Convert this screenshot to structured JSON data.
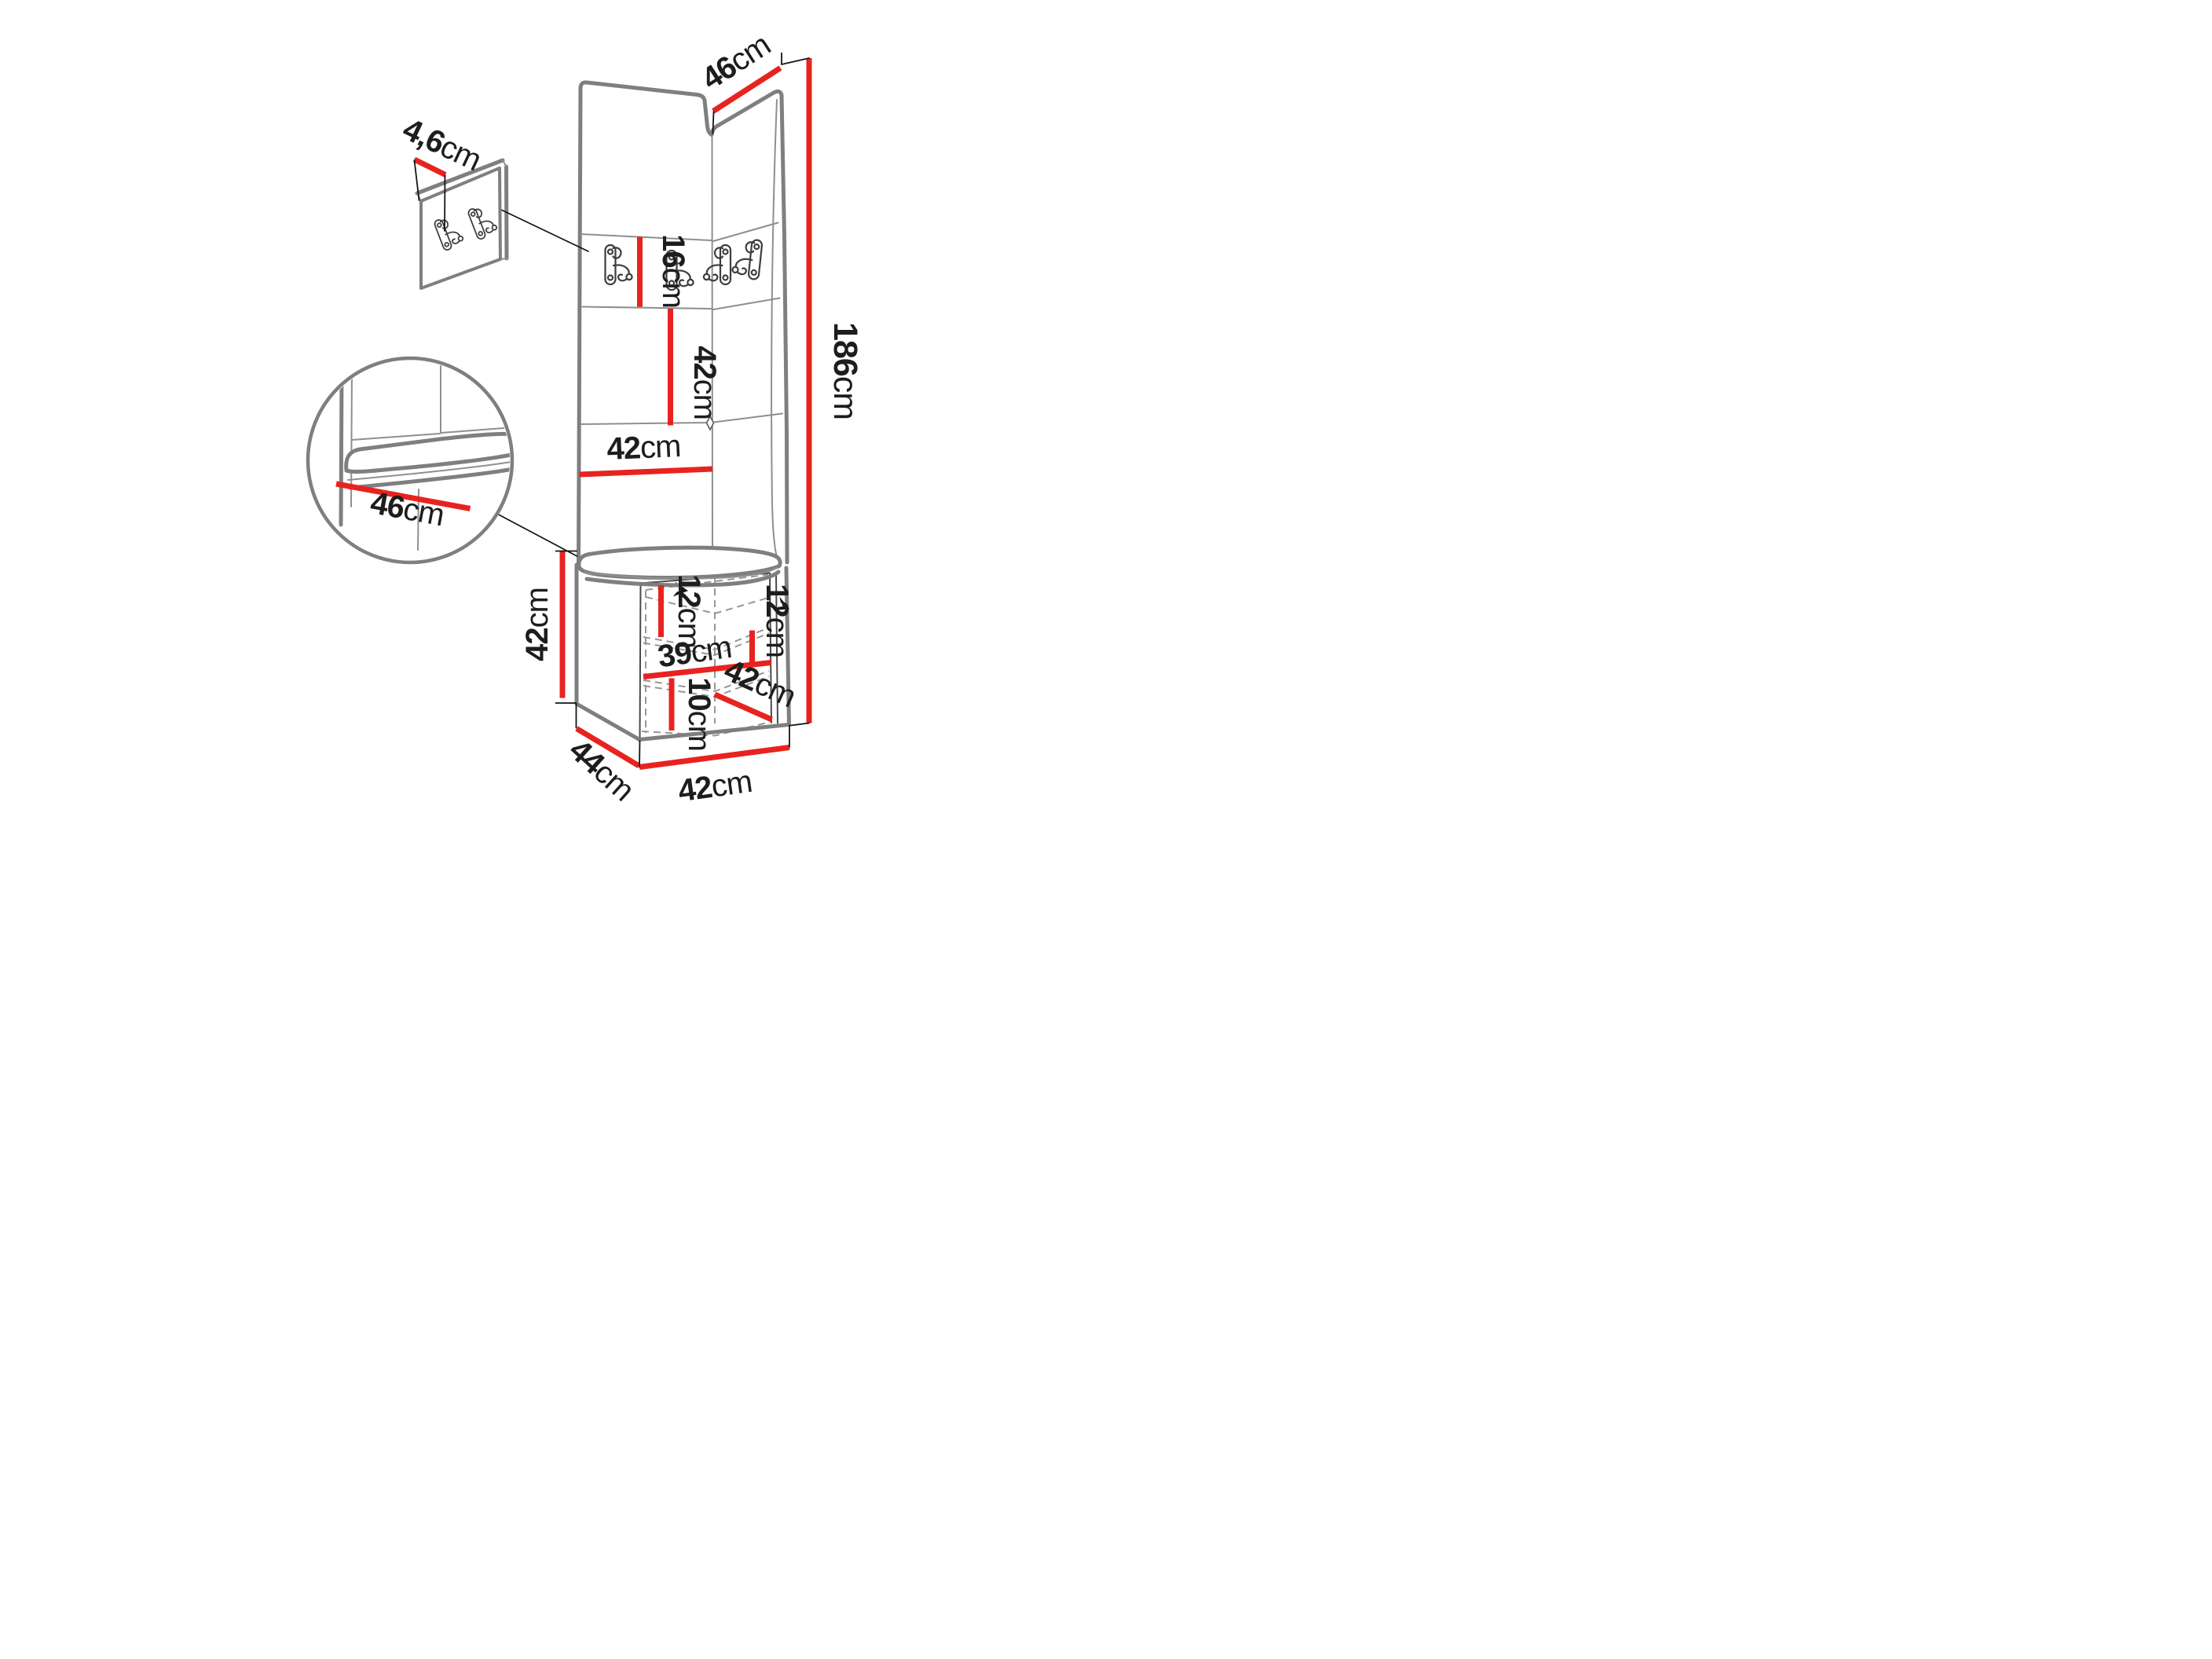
{
  "page": {
    "background": "#ffffff"
  },
  "diagram": {
    "type": "furniture-dimension-drawing",
    "subject": "corner hallway set: upholstered wall panels with coat hooks, bench cushion and open shoe cabinet",
    "colors": {
      "dimension_red": "#e8231f",
      "structure_gray": "#7f7f7f",
      "text": "#1d1d1b"
    },
    "icons": [
      "double-coat-hook-icon",
      "opening-direction-arrow-icon"
    ],
    "dims": {
      "top_panel_width": {
        "value": "46",
        "unit": "cm"
      },
      "panel_thickness": {
        "value": "4,6",
        "unit": "cm"
      },
      "hook_strip_height": {
        "value": "16",
        "unit": "cm"
      },
      "mid_panel_height": {
        "value": "42",
        "unit": "cm"
      },
      "total_height": {
        "value": "186",
        "unit": "cm"
      },
      "panel_width": {
        "value": "42",
        "unit": "cm"
      },
      "seat_depth": {
        "value": "46",
        "unit": "cm"
      },
      "bench_height": {
        "value": "42",
        "unit": "cm"
      },
      "top_shelf_height": {
        "value": "12",
        "unit": "cm"
      },
      "right_shelf_height": {
        "value": "12",
        "unit": "cm"
      },
      "interior_width": {
        "value": "39",
        "unit": "cm"
      },
      "bottom_shelf_height": {
        "value": "10",
        "unit": "cm"
      },
      "door_width": {
        "value": "42",
        "unit": "cm"
      },
      "base_depth": {
        "value": "44",
        "unit": "cm"
      },
      "base_width": {
        "value": "42",
        "unit": "cm"
      }
    }
  }
}
